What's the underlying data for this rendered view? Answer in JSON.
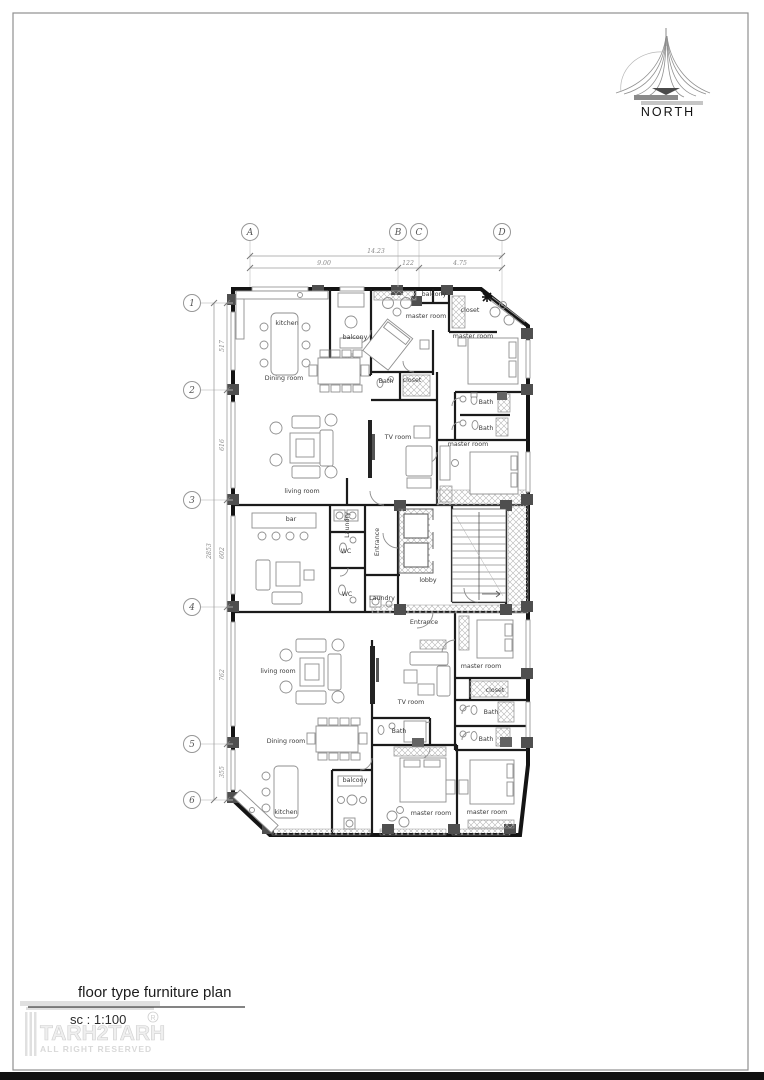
{
  "north": {
    "label": "NORTH"
  },
  "title_block": {
    "title": "floor type furniture plan",
    "scale": "sc : 1:100",
    "watermark_name": "TARH2TARH",
    "watermark_reg": "R",
    "watermark_rights": "ALL RIGHT RESERVED"
  },
  "colors": {
    "wall": "#141414",
    "column": "#4f4f4f",
    "furniture": "#8f8f8f",
    "hatch": "#b5b5b5",
    "bottom_bar": "#101010",
    "page_border": "#8f8f8f"
  },
  "grid": {
    "bubble_y": 232,
    "bubble_x": 192,
    "columns": [
      {
        "label": "A",
        "x": 250,
        "ext": 287
      },
      {
        "label": "B",
        "x": 398,
        "ext": 287
      },
      {
        "label": "C",
        "x": 419,
        "ext": 287
      },
      {
        "label": "D",
        "x": 502,
        "ext": 306
      }
    ],
    "rows": [
      {
        "label": "1",
        "y": 303,
        "ext": 233
      },
      {
        "label": "2",
        "y": 390,
        "ext": 233
      },
      {
        "label": "3",
        "y": 500,
        "ext": 233
      },
      {
        "label": "4",
        "y": 607,
        "ext": 233
      },
      {
        "label": "5",
        "y": 744,
        "ext": 233
      },
      {
        "label": "6",
        "y": 800,
        "ext": 233
      }
    ]
  },
  "dimensions": {
    "lines": [
      {
        "x1": 250,
        "y1": 256,
        "x2": 502,
        "y2": 256,
        "ticks": [
          [
            250,
            256
          ],
          [
            502,
            256
          ]
        ]
      },
      {
        "x1": 250,
        "y1": 268,
        "x2": 502,
        "y2": 268,
        "ticks": [
          [
            250,
            268
          ],
          [
            398,
            268
          ],
          [
            419,
            268
          ],
          [
            502,
            268
          ]
        ]
      },
      {
        "x1": 214,
        "y1": 303,
        "x2": 214,
        "y2": 800,
        "ticks": [
          [
            214,
            303
          ],
          [
            214,
            800
          ]
        ]
      },
      {
        "x1": 227,
        "y1": 303,
        "x2": 227,
        "y2": 800,
        "ticks": [
          [
            227,
            303
          ],
          [
            227,
            390
          ],
          [
            227,
            500
          ],
          [
            227,
            607
          ],
          [
            227,
            744
          ],
          [
            227,
            800
          ]
        ]
      }
    ],
    "labels": [
      {
        "text": "14.23",
        "x": 376,
        "y": 253
      },
      {
        "text": "9.00",
        "x": 324,
        "y": 265
      },
      {
        "text": "122",
        "x": 408,
        "y": 265
      },
      {
        "text": "4.75",
        "x": 460,
        "y": 265
      },
      {
        "text": "2853",
        "x": 211,
        "y": 551,
        "rot": -90
      },
      {
        "text": "517",
        "x": 224,
        "y": 346,
        "rot": -90
      },
      {
        "text": "616",
        "x": 224,
        "y": 445,
        "rot": -90
      },
      {
        "text": "602",
        "x": 224,
        "y": 553,
        "rot": -90
      },
      {
        "text": "762",
        "x": 224,
        "y": 675,
        "rot": -90
      },
      {
        "text": "355",
        "x": 224,
        "y": 772,
        "rot": -90
      }
    ]
  },
  "plan": {
    "rooms": [
      {
        "text": "kitchen",
        "x": 287,
        "y": 325
      },
      {
        "text": "balcony",
        "x": 355,
        "y": 339
      },
      {
        "text": "Dining room",
        "x": 284,
        "y": 380
      },
      {
        "text": "master room",
        "x": 426,
        "y": 318
      },
      {
        "text": "balcony",
        "x": 434,
        "y": 296
      },
      {
        "text": "closet",
        "x": 470,
        "y": 312
      },
      {
        "text": "master room",
        "x": 473,
        "y": 338
      },
      {
        "text": "Bath",
        "x": 386,
        "y": 383
      },
      {
        "text": "closet",
        "x": 412,
        "y": 382
      },
      {
        "text": "Bath",
        "x": 486,
        "y": 404
      },
      {
        "text": "Bath",
        "x": 486,
        "y": 430
      },
      {
        "text": "TV room",
        "x": 398,
        "y": 439
      },
      {
        "text": "master room",
        "x": 468,
        "y": 446
      },
      {
        "text": "living room",
        "x": 302,
        "y": 493
      },
      {
        "text": "bar",
        "x": 291,
        "y": 521
      },
      {
        "text": "Laundry",
        "x": 349,
        "y": 525,
        "rot": -90
      },
      {
        "text": "WC",
        "x": 346,
        "y": 553
      },
      {
        "text": "Entrance",
        "x": 379,
        "y": 542,
        "rot": -90
      },
      {
        "text": "lobby",
        "x": 428,
        "y": 582,
        "size": 10.5
      },
      {
        "text": "WC",
        "x": 347,
        "y": 596
      },
      {
        "text": "Laundry",
        "x": 382,
        "y": 600
      },
      {
        "text": "Entrance",
        "x": 424,
        "y": 624
      },
      {
        "text": "master room",
        "x": 481,
        "y": 668
      },
      {
        "text": "living room",
        "x": 278,
        "y": 673
      },
      {
        "text": "closet",
        "x": 495,
        "y": 692
      },
      {
        "text": "TV room",
        "x": 411,
        "y": 704
      },
      {
        "text": "Bath",
        "x": 491,
        "y": 714
      },
      {
        "text": "Bath",
        "x": 399,
        "y": 733
      },
      {
        "text": "Bath",
        "x": 486,
        "y": 741
      },
      {
        "text": "Dining room",
        "x": 286,
        "y": 743
      },
      {
        "text": "balcony",
        "x": 355,
        "y": 782
      },
      {
        "text": "kitchen",
        "x": 286,
        "y": 814
      },
      {
        "text": "master room",
        "x": 431,
        "y": 815
      },
      {
        "text": "master room",
        "x": 487,
        "y": 814
      }
    ]
  }
}
